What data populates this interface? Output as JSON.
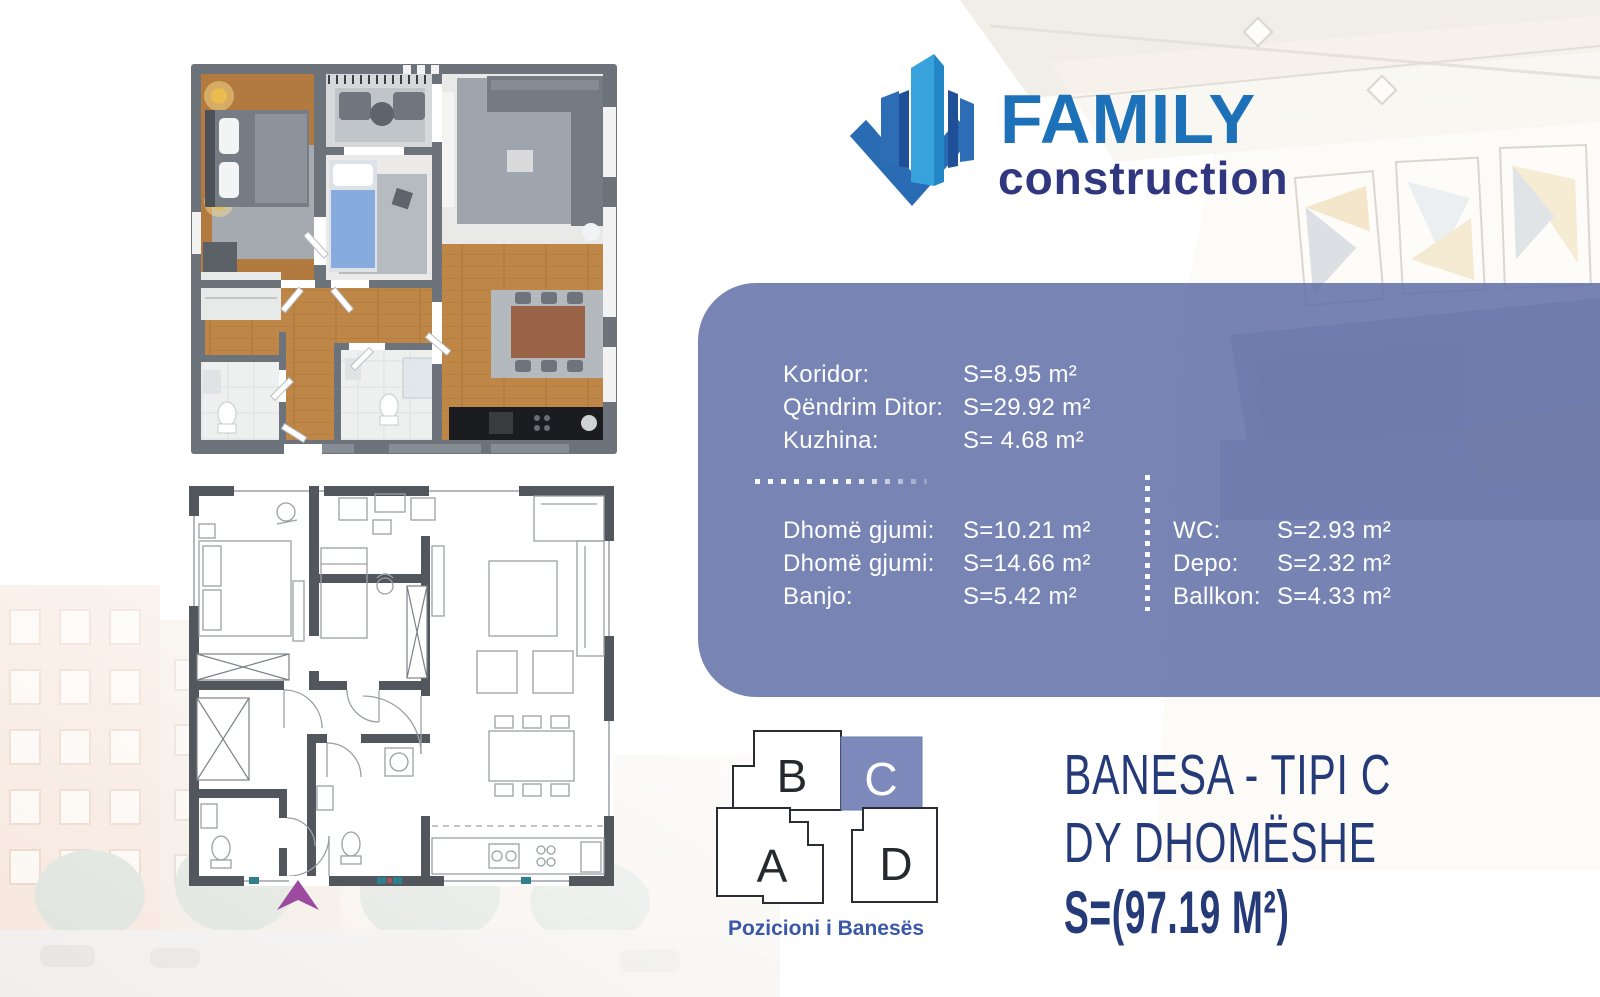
{
  "brand": {
    "name": "FAMILY",
    "tagline": "construction"
  },
  "areas": {
    "group_top": [
      {
        "label": "Koridor:",
        "value": "S=8.95 m²"
      },
      {
        "label": "Qëndrim Ditor:",
        "value": "S=29.92 m²"
      },
      {
        "label": "Kuzhina:",
        "value": "S= 4.68 m²"
      }
    ],
    "group_left": [
      {
        "label": "Dhomë gjumi:",
        "value": "S=10.21 m²"
      },
      {
        "label": "Dhomë gjumi:",
        "value": "S=14.66 m²"
      },
      {
        "label": "Banjo:",
        "value": "S=5.42 m²"
      }
    ],
    "group_right": [
      {
        "label": "WC:",
        "value": "S=2.93 m²"
      },
      {
        "label": "Depo:",
        "value": "S=2.32 m²"
      },
      {
        "label": "Ballkon:",
        "value": "S=4.33 m²"
      }
    ]
  },
  "position": {
    "caption": "Pozicioni i Banesës",
    "blocks": {
      "a": "A",
      "b": "B",
      "c": "C",
      "d": "D"
    },
    "highlighted": "C"
  },
  "title": {
    "line1": "BANESA - TIPI C",
    "line2": "DY DHOMËSHE",
    "line3": "S=(97.19 M²)"
  },
  "colors": {
    "panel": "#7784b4",
    "accent_blue": "#1d71b8",
    "navy": "#253a78",
    "highlight_block": "#7d8abb",
    "entrance_arrow": "#9c4b9f"
  }
}
